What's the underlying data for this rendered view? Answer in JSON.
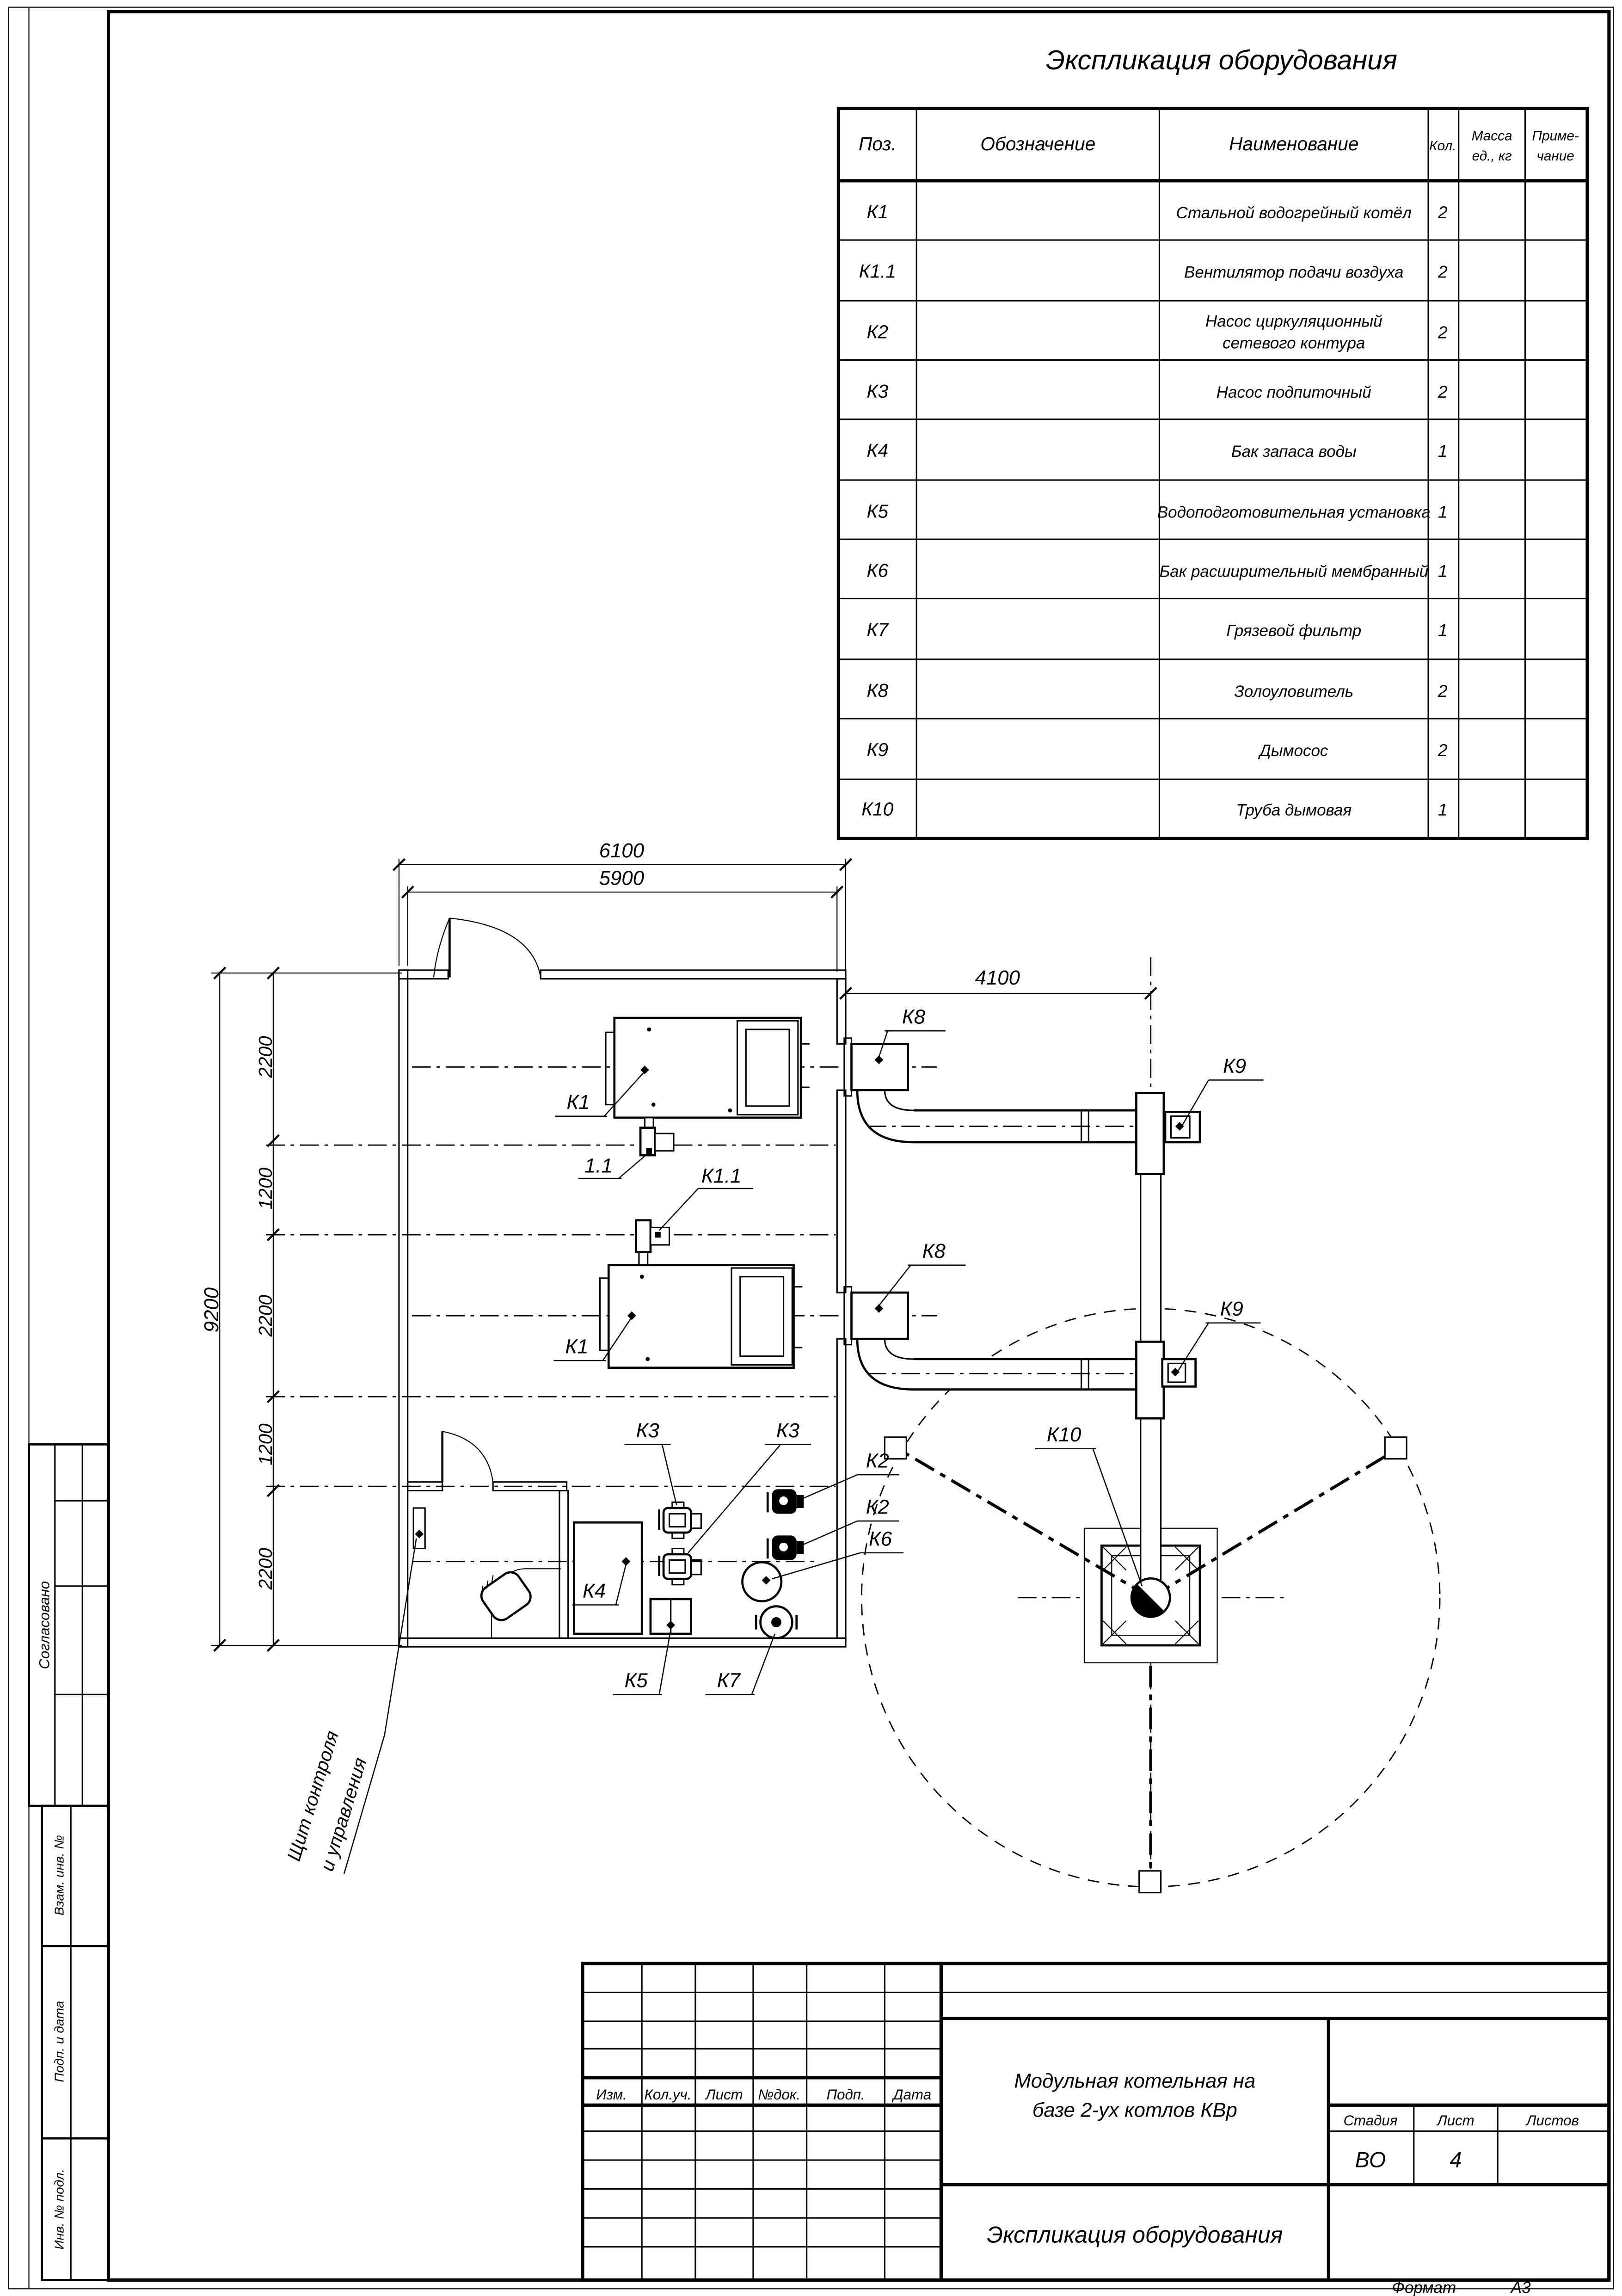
{
  "colors": {
    "ink": "#000000",
    "paper": "#ffffff"
  },
  "sheet": {
    "table_title": "Экспликация оборудования",
    "format_label": "Формат",
    "format_value": "А3"
  },
  "equipment_table": {
    "headers": {
      "pos": "Поз.",
      "designation": "Обозначение",
      "name": "Наименование",
      "qty": "Кол.",
      "mass_line1": "Масса",
      "mass_line2": "ед., кг",
      "note_line1": "Приме-",
      "note_line2": "чание"
    },
    "rows": [
      {
        "pos": "К1",
        "name": "Стальной водогрейный котёл",
        "qty": "2"
      },
      {
        "pos": "К1.1",
        "name": "Вентилятор подачи воздуха",
        "qty": "2"
      },
      {
        "pos": "К2",
        "name": "Насос циркуляционный",
        "name2": "сетевого контура",
        "qty": "2"
      },
      {
        "pos": "К3",
        "name": "Насос подпиточный",
        "qty": "2"
      },
      {
        "pos": "К4",
        "name": "Бак запаса воды",
        "qty": "1"
      },
      {
        "pos": "К5",
        "name": "Водоподготовительная установка",
        "qty": "1"
      },
      {
        "pos": "К6",
        "name": "Бак расширительный мембранный",
        "qty": "1"
      },
      {
        "pos": "К7",
        "name": "Грязевой фильтр",
        "qty": "1"
      },
      {
        "pos": "К8",
        "name": "Золоуловитель",
        "qty": "2"
      },
      {
        "pos": "К9",
        "name": "Дымосос",
        "qty": "2"
      },
      {
        "pos": "К10",
        "name": "Труба дымовая",
        "qty": "1"
      }
    ]
  },
  "plan": {
    "dims": {
      "width_outer": "6100",
      "width_inner": "5900",
      "flue_offset": "4100",
      "height_total": "9200",
      "seg1": "2200",
      "seg2": "1200",
      "seg3": "2200",
      "seg4": "1200",
      "seg5": "2200"
    },
    "labels": {
      "k1_top": "К1",
      "k1_bottom": "К1",
      "fan_top": "1.1",
      "fan_bottom": "К1.1",
      "k8_top": "К8",
      "k8_bottom": "К8",
      "k9_top": "К9",
      "k9_bottom": "К9",
      "k10": "К10",
      "k2_a": "К2",
      "k2_b": "К2",
      "k6": "К6",
      "k3_a": "К3",
      "k3_b": "К3",
      "k4": "К4",
      "k5": "К5",
      "k7": "К7",
      "panel_line1": "Щит контроля",
      "panel_line2": "и управления"
    }
  },
  "stamps": {
    "approved": "Согласовано",
    "zam_inv": "Взам. инв. №",
    "podp_data": "Подп. и дата",
    "inv_podl": "Инв. № подл."
  },
  "title_block": {
    "rev_headers": {
      "izm": "Изм.",
      "koluch": "Кол.уч.",
      "list": "Лист",
      "ndok": "№док.",
      "podp": "Подп.",
      "data": "Дата"
    },
    "title_line1": "Модульная котельная на",
    "title_line2": "базе 2-ух котлов КВр",
    "doc_name": "Экспликация оборудования",
    "stage_label": "Стадия",
    "sheet_label": "Лист",
    "sheets_label": "Листов",
    "stage_value": "ВО",
    "sheet_value": "4",
    "sheets_value": ""
  }
}
